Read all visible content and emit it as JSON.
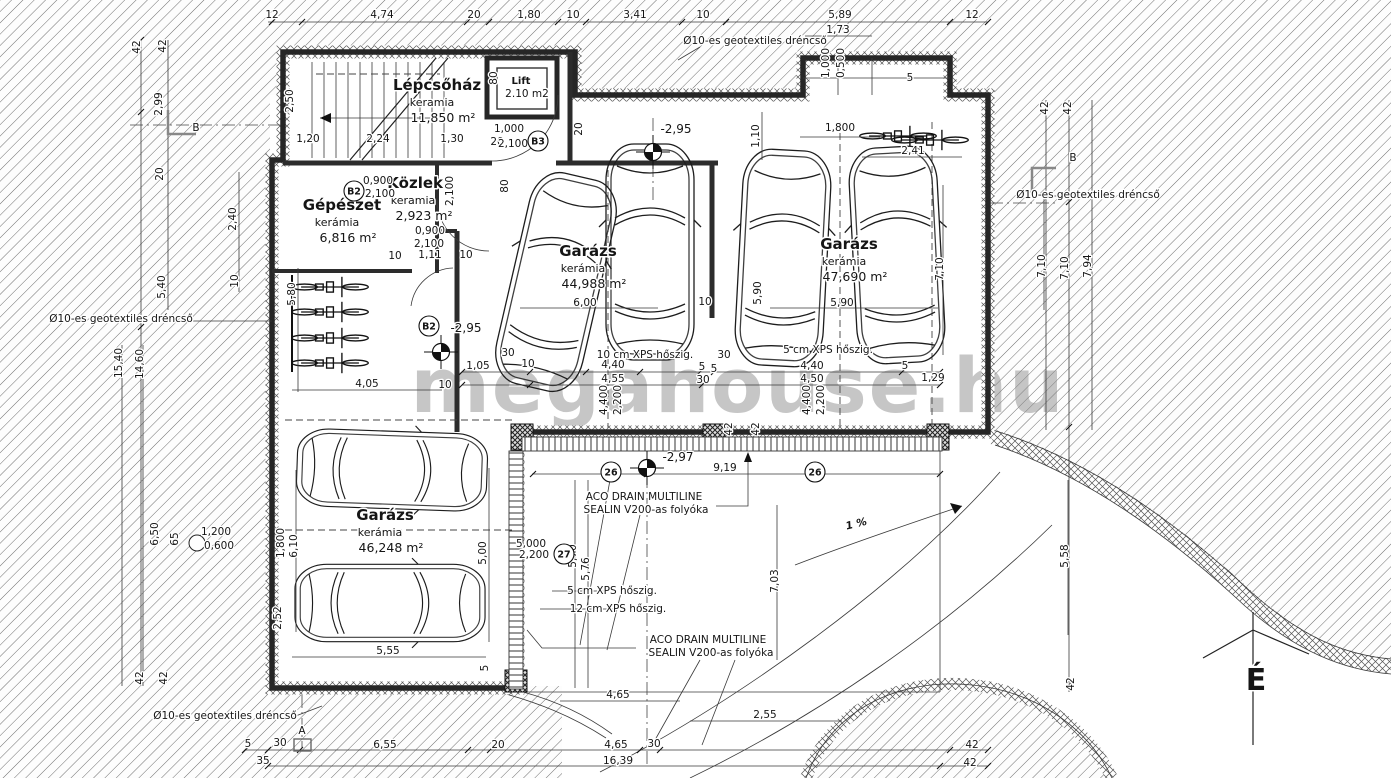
{
  "watermark": "megahouse.hu",
  "north_label": "É",
  "rooms": [
    {
      "name": "Lépcsőház",
      "material": "keramia",
      "area": "11,850 m²",
      "x": 437,
      "y": 90
    },
    {
      "name": "Lift",
      "area": "2.10 m2",
      "x": 521,
      "y": 84,
      "ns": 10
    },
    {
      "name": "Közlek.",
      "material": "keramia",
      "area": "2,923 m²",
      "x": 418,
      "y": 188
    },
    {
      "name": "Gépészet",
      "material": "kerámia",
      "area": "6,816 m²",
      "x": 342,
      "y": 210
    },
    {
      "name": "Garázs",
      "material": "kerámia",
      "area": "44,988 m²",
      "x": 588,
      "y": 256
    },
    {
      "name": "Garázs",
      "material": "kerámia",
      "area": "47,690 m²",
      "x": 849,
      "y": 249
    },
    {
      "name": "Garázs",
      "material": "kerámia",
      "area": "46,248 m²",
      "x": 385,
      "y": 520
    }
  ],
  "levels": [
    {
      "t": "-2,95",
      "sx": 653,
      "sy": 152,
      "tx": 676,
      "ty": 133
    },
    {
      "t": "-2,95",
      "sx": 441,
      "sy": 352,
      "tx": 466,
      "ty": 332
    },
    {
      "t": "-2,97",
      "sx": 647,
      "sy": 468,
      "tx": 678,
      "ty": 461
    }
  ],
  "tags": [
    {
      "t": "B3",
      "x": 538,
      "y": 141
    },
    {
      "t": "B2",
      "x": 354,
      "y": 191
    },
    {
      "t": "B2",
      "x": 429,
      "y": 326
    },
    {
      "t": "26",
      "x": 611,
      "y": 472
    },
    {
      "t": "26",
      "x": 815,
      "y": 472
    },
    {
      "t": "27",
      "x": 564,
      "y": 554
    }
  ],
  "notes": [
    {
      "t": "Ø10-es geotextiles dréncső",
      "x": 755,
      "y": 44
    },
    {
      "t": "Ø10-es geotextiles dréncső",
      "x": 1088,
      "y": 198,
      "a": "start"
    },
    {
      "t": "Ø10-es geotextiles dréncső",
      "x": 121,
      "y": 322,
      "s": 9.5
    },
    {
      "t": "Ø10-es geotextiles dréncső",
      "x": 225,
      "y": 719,
      "s": 9.5
    },
    {
      "t": "10 cm XPS hőszig.",
      "x": 645,
      "y": 358
    },
    {
      "t": "5 cm XPS hőszig.",
      "x": 828,
      "y": 353
    },
    {
      "t": "5 cm XPS hőszig.",
      "x": 612,
      "y": 594,
      "a": "start"
    },
    {
      "t": "12 cm XPS hőszig.",
      "x": 618,
      "y": 612,
      "a": "start"
    },
    {
      "t": "ACO DRAIN MULTILINE",
      "x": 644,
      "y": 500
    },
    {
      "t": "SEALIN V200-as folyóka",
      "x": 646,
      "y": 513
    },
    {
      "t": "ACO DRAIN MULTILINE",
      "x": 708,
      "y": 643
    },
    {
      "t": "SEALIN V200-as folyóka",
      "x": 711,
      "y": 656
    },
    {
      "t": "1 %",
      "x": 857,
      "y": 527,
      "r": -14,
      "s": 20,
      "b": 1,
      "i": 1
    },
    {
      "t": "B",
      "x": 196,
      "y": 131,
      "s": 20
    },
    {
      "t": "B",
      "x": 1073,
      "y": 161,
      "s": 20
    },
    {
      "t": "A",
      "x": 302,
      "y": 734,
      "s": 17
    }
  ],
  "dim_labels": [
    {
      "t": "12",
      "x": 272,
      "y": 18
    },
    {
      "t": "4,74",
      "x": 382,
      "y": 18
    },
    {
      "t": "20",
      "x": 474,
      "y": 18
    },
    {
      "t": "1,80",
      "x": 529,
      "y": 18
    },
    {
      "t": "10",
      "x": 573,
      "y": 18
    },
    {
      "t": "3,41",
      "x": 635,
      "y": 18
    },
    {
      "t": "10",
      "x": 703,
      "y": 18
    },
    {
      "t": "5,89",
      "x": 840,
      "y": 18
    },
    {
      "t": "12",
      "x": 972,
      "y": 18
    },
    {
      "t": "1,73",
      "x": 838,
      "y": 33
    },
    {
      "t": "1,000",
      "x": 829,
      "y": 63,
      "r": 1,
      "s": 9
    },
    {
      "t": "0,500",
      "x": 844,
      "y": 63,
      "r": 1,
      "s": 9
    },
    {
      "t": "5",
      "x": 910,
      "y": 81
    },
    {
      "t": "1,800",
      "x": 840,
      "y": 131
    },
    {
      "t": "2,41",
      "x": 913,
      "y": 154
    },
    {
      "t": "1,10",
      "x": 759,
      "y": 136,
      "r": 1
    },
    {
      "t": "20",
      "x": 582,
      "y": 129,
      "r": 1
    },
    {
      "t": "80",
      "x": 497,
      "y": 78,
      "r": 1
    },
    {
      "t": "2,50",
      "x": 293,
      "y": 101,
      "r": 1
    },
    {
      "t": "1,20",
      "x": 308,
      "y": 142
    },
    {
      "t": "2,24",
      "x": 378,
      "y": 142
    },
    {
      "t": "1,30",
      "x": 452,
      "y": 142
    },
    {
      "t": "20",
      "x": 497,
      "y": 145,
      "s": 9
    },
    {
      "t": "1,000",
      "x": 509,
      "y": 132,
      "s": 9.5
    },
    {
      "t": "2,100",
      "x": 513,
      "y": 147,
      "s": 9.5
    },
    {
      "t": "42",
      "x": 140,
      "y": 47,
      "r": 1
    },
    {
      "t": "42",
      "x": 166,
      "y": 46,
      "r": 1
    },
    {
      "t": "2,99",
      "x": 162,
      "y": 104,
      "r": 1
    },
    {
      "t": "20",
      "x": 163,
      "y": 174,
      "r": 1
    },
    {
      "t": "2,40",
      "x": 236,
      "y": 219,
      "r": 1
    },
    {
      "t": "10",
      "x": 238,
      "y": 281,
      "r": 1
    },
    {
      "t": "5,40",
      "x": 165,
      "y": 287,
      "r": 1
    },
    {
      "t": "15,40",
      "x": 122,
      "y": 363,
      "r": 1
    },
    {
      "t": "14,60",
      "x": 143,
      "y": 364,
      "r": 1
    },
    {
      "t": "6,50",
      "x": 158,
      "y": 534,
      "r": 1
    },
    {
      "t": "65",
      "x": 178,
      "y": 539,
      "r": 1
    },
    {
      "t": "1,200",
      "x": 216,
      "y": 535,
      "s": 9
    },
    {
      "t": "0,600",
      "x": 219,
      "y": 549,
      "s": 9
    },
    {
      "t": "0,900",
      "x": 378,
      "y": 184,
      "s": 9.5
    },
    {
      "t": "2,100",
      "x": 380,
      "y": 197,
      "s": 9.5
    },
    {
      "t": "0,900",
      "x": 430,
      "y": 234,
      "s": 9.5
    },
    {
      "t": "2,100",
      "x": 429,
      "y": 247,
      "s": 9.5
    },
    {
      "t": "10",
      "x": 395,
      "y": 259
    },
    {
      "t": "1,11",
      "x": 430,
      "y": 258
    },
    {
      "t": "10",
      "x": 466,
      "y": 258
    },
    {
      "t": "2,100",
      "x": 453,
      "y": 191,
      "r": 1,
      "s": 9
    },
    {
      "t": "80",
      "x": 508,
      "y": 186,
      "r": 1
    },
    {
      "t": "5,80",
      "x": 295,
      "y": 294,
      "r": 1
    },
    {
      "t": "4,05",
      "x": 367,
      "y": 387
    },
    {
      "t": "10",
      "x": 445,
      "y": 388
    },
    {
      "t": "6,00",
      "x": 585,
      "y": 306
    },
    {
      "t": "10",
      "x": 705,
      "y": 305
    },
    {
      "t": "5,90",
      "x": 761,
      "y": 293,
      "r": 1
    },
    {
      "t": "5,90",
      "x": 842,
      "y": 306
    },
    {
      "t": "7,10",
      "x": 943,
      "y": 269,
      "r": 1
    },
    {
      "t": "30",
      "x": 508,
      "y": 356
    },
    {
      "t": "10",
      "x": 528,
      "y": 367
    },
    {
      "t": "1,05",
      "x": 478,
      "y": 369
    },
    {
      "t": "4,40",
      "x": 613,
      "y": 368
    },
    {
      "t": "4,55",
      "x": 613,
      "y": 382
    },
    {
      "t": "4,400",
      "x": 607,
      "y": 400,
      "r": 1,
      "s": 9
    },
    {
      "t": "2,200",
      "x": 621,
      "y": 400,
      "r": 1,
      "s": 9
    },
    {
      "t": "5",
      "x": 702,
      "y": 370
    },
    {
      "t": "5",
      "x": 714,
      "y": 372
    },
    {
      "t": "30",
      "x": 703,
      "y": 383
    },
    {
      "t": "4,40",
      "x": 812,
      "y": 369
    },
    {
      "t": "4,50",
      "x": 812,
      "y": 382
    },
    {
      "t": "4,400",
      "x": 810,
      "y": 400,
      "r": 1,
      "s": 9
    },
    {
      "t": "2,200",
      "x": 824,
      "y": 400,
      "r": 1,
      "s": 9
    },
    {
      "t": "5",
      "x": 905,
      "y": 369
    },
    {
      "t": "1,29",
      "x": 933,
      "y": 381
    },
    {
      "t": "30",
      "x": 724,
      "y": 358
    },
    {
      "t": "42",
      "x": 732,
      "y": 429,
      "r": 1,
      "s": 9
    },
    {
      "t": "42",
      "x": 759,
      "y": 429,
      "r": 1,
      "s": 9
    },
    {
      "t": "42",
      "x": 1048,
      "y": 108,
      "r": 1
    },
    {
      "t": "42",
      "x": 1071,
      "y": 108,
      "r": 1
    },
    {
      "t": "7,10",
      "x": 1045,
      "y": 266,
      "r": 1
    },
    {
      "t": "7,10",
      "x": 1068,
      "y": 268,
      "r": 1
    },
    {
      "t": "7,94",
      "x": 1091,
      "y": 266,
      "r": 1
    },
    {
      "t": "9,19",
      "x": 725,
      "y": 471
    },
    {
      "t": "5,000",
      "x": 531,
      "y": 547,
      "s": 9
    },
    {
      "t": "2,200",
      "x": 534,
      "y": 558,
      "s": 9
    },
    {
      "t": "5,70",
      "x": 576,
      "y": 556,
      "r": 1
    },
    {
      "t": "5,76",
      "x": 589,
      "y": 569,
      "r": 1
    },
    {
      "t": "7,03",
      "x": 778,
      "y": 581,
      "r": 1
    },
    {
      "t": "5,58",
      "x": 1068,
      "y": 556,
      "r": 1
    },
    {
      "t": "42",
      "x": 1074,
      "y": 684,
      "r": 1
    },
    {
      "t": "5,00",
      "x": 486,
      "y": 553,
      "r": 1
    },
    {
      "t": "6,10",
      "x": 297,
      "y": 546,
      "r": 1
    },
    {
      "t": "1,800",
      "x": 284,
      "y": 543,
      "r": 1,
      "s": 9
    },
    {
      "t": "2,52",
      "x": 281,
      "y": 618,
      "r": 1,
      "s": 9
    },
    {
      "t": "5,55",
      "x": 388,
      "y": 654
    },
    {
      "t": "5",
      "x": 488,
      "y": 668,
      "r": 1,
      "s": 9
    },
    {
      "t": "5",
      "x": 248,
      "y": 747,
      "s": 9
    },
    {
      "t": "30",
      "x": 280,
      "y": 746
    },
    {
      "t": "6,55",
      "x": 385,
      "y": 748
    },
    {
      "t": "20",
      "x": 498,
      "y": 748
    },
    {
      "t": "4,65",
      "x": 616,
      "y": 748
    },
    {
      "t": "30",
      "x": 654,
      "y": 747
    },
    {
      "t": "16,39",
      "x": 618,
      "y": 764
    },
    {
      "t": "35",
      "x": 263,
      "y": 764
    },
    {
      "t": "42",
      "x": 972,
      "y": 748
    },
    {
      "t": "42",
      "x": 970,
      "y": 766
    },
    {
      "t": "4,65",
      "x": 618,
      "y": 698
    },
    {
      "t": "2,55",
      "x": 765,
      "y": 718
    },
    {
      "t": "42",
      "x": 143,
      "y": 678,
      "r": 1
    },
    {
      "t": "42",
      "x": 167,
      "y": 678,
      "r": 1
    }
  ]
}
